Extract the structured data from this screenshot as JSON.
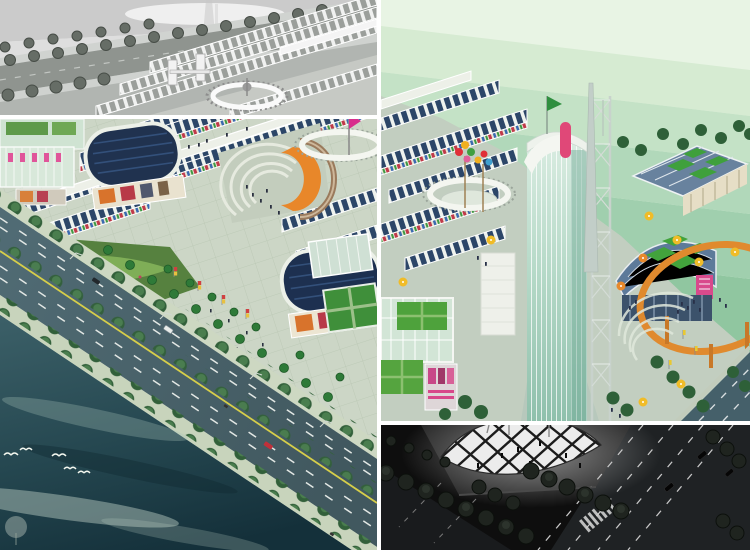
{
  "page": {
    "title": "Commercial plaza master-plan renderings collage"
  },
  "palette": {
    "divider": "#ffffff",
    "plaza": "#ccd6c6",
    "sky-light": "#e6f3e2",
    "sky-dark": "#8cc49c",
    "night": "#0e0e0e",
    "water-teal": "#24444c",
    "road-slate": "#4a656f",
    "roof-navy": "#1d3050",
    "accent-orange": "#e8872a",
    "grass-green": "#4ea23c",
    "glass-teal": "#9fc8bc",
    "lane-yellow": "#d6ce4a",
    "billboard-pink": "#d8488a"
  },
  "panels": {
    "top_left": {
      "label": "Grayscale aerial rendering: tree-lined road, market halls, ring plaza"
    },
    "main": {
      "label": "Color aerial rendering: market rows, oval halls, amphitheater, boulevard and waterfront with birds"
    },
    "right": {
      "label": "Color rendering: glass observation tower with spire, green-checker roofs, orange ring arch, banded green sky"
    },
    "bottom_right": {
      "label": "Night rendering: glowing lattice canopy at a dark street corner with trees and lane markings"
    }
  }
}
